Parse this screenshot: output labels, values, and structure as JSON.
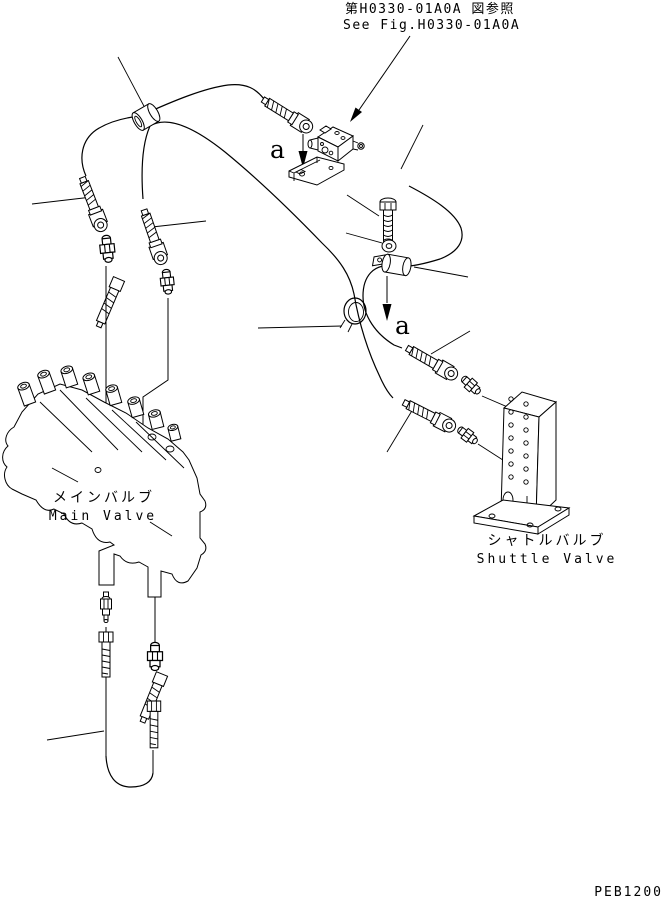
{
  "page": {
    "background": "#ffffff",
    "line_color": "#000000"
  },
  "reference_note": {
    "jp": "第H0330-01A0A 図参照",
    "en": "See Fig.H0330-01A0A"
  },
  "markers": {
    "upper_a": "a",
    "lower_a": "a"
  },
  "components": {
    "main_valve": {
      "jp": "メインバルブ",
      "en": "Main Valve"
    },
    "shuttle_valve": {
      "jp": "シャトルバルブ",
      "en": "Shuttle Valve"
    }
  },
  "drawing_number": "PEB1200"
}
